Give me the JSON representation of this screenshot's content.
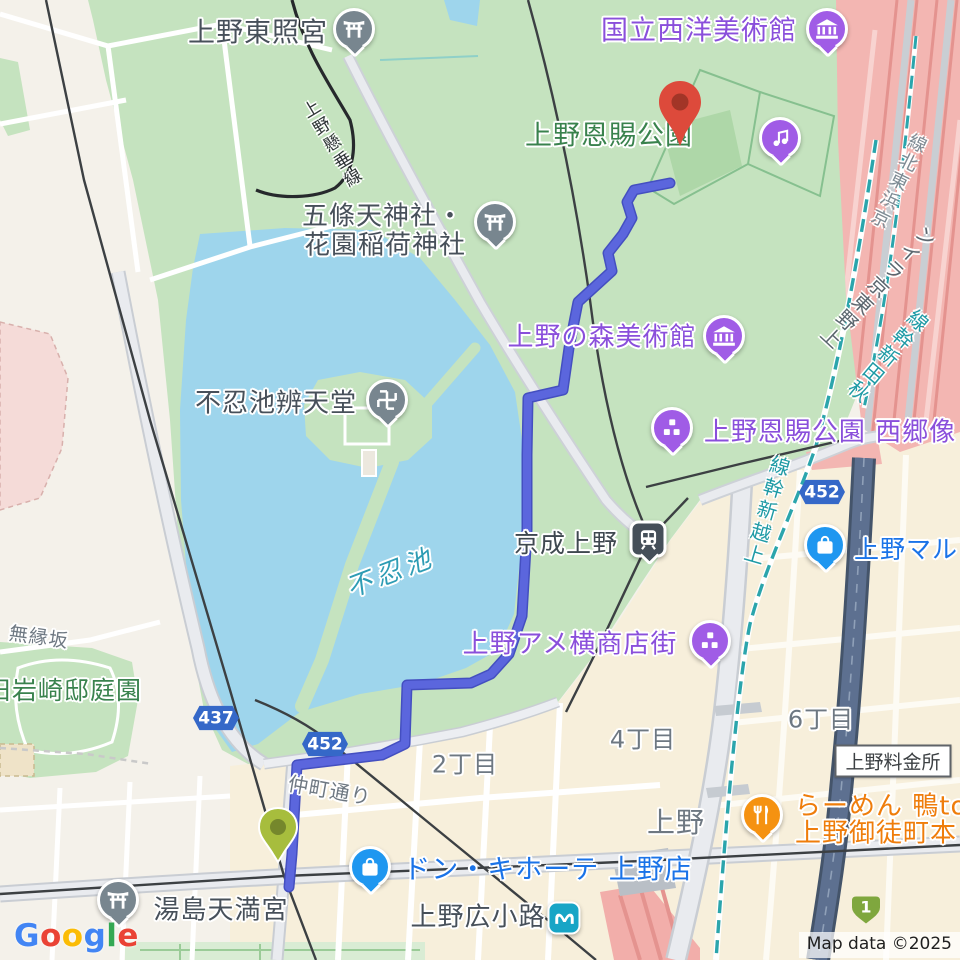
{
  "map": {
    "attribution": "Map data ©2025",
    "logo_letters": [
      "G",
      "o",
      "o",
      "g",
      "l",
      "e"
    ]
  },
  "colors": {
    "route_blue": "#5b66dd",
    "park_green": "#c5e3bf",
    "water_blue": "#9ed5ec",
    "rail_yard_pink": "#f3b6b2",
    "expressway_dark": "#5d7090",
    "city_blocks_cream": "#f7efdb",
    "road_shield_blue": "#3568c8",
    "expressway_shield_green": "#7fa73e",
    "poi_purple": "#a05ce6",
    "poi_gray": "#78868f",
    "poi_blue": "#1f97f0",
    "poi_orange": "#f59211",
    "destination_pin_red": "#dd4a3b",
    "start_pin_olive": "#a7bd3d"
  },
  "pois": {
    "ueno_toshogu": {
      "label": "上野東照宮"
    },
    "kokuritsu_seiyo_bijutsukan": {
      "label": "国立西洋美術館"
    },
    "ueno_onshi_koen": {
      "label": "上野恩賜公園"
    },
    "gojoten_jinja": {
      "label_line1": "五條天神社・",
      "label_line2": "花園稲荷神社"
    },
    "ueno_no_mori_bijutsukan": {
      "label": "上野の森美術館"
    },
    "shinobazunoike_bentendo": {
      "label": "不忍池辨天堂"
    },
    "saigo_statue": {
      "label": "上野恩賜公園 西郷像"
    },
    "keisei_ueno": {
      "label": "京成上野"
    },
    "ueno_maru": {
      "label": "上野マル"
    },
    "ameyoko": {
      "label": "上野アメ横商店街"
    },
    "kyu_iwasaki_tei": {
      "label": "旧岩崎邸庭園"
    },
    "yushima_tenmangu": {
      "label": "湯島天満宮"
    },
    "don_quijote": {
      "label": "ドン・キホーテ 上野店"
    },
    "ueno_hirokoji": {
      "label": "上野広小路"
    },
    "ramen_kamo": {
      "label_line1": "らーめん 鴨to",
      "label_line2": "上野御徒町本"
    },
    "ueno_tollgate": {
      "label": "上野料金所"
    }
  },
  "area_labels": {
    "shinobazu_pond": "不忍池",
    "muenzaka": "無縁坂",
    "nakacho_dori": "仲町通り",
    "chome2": "2丁目",
    "chome4": "4丁目",
    "chome6": "6丁目",
    "ueno": "上野"
  },
  "railway_labels": {
    "keihin_tohoku_line": "京浜東北線",
    "ueno_tokyo_line": "上野東京ライン",
    "akita_shinkansen": "秋田新幹線",
    "joetsu_shinkansen": "上越新幹線",
    "ueno_kensui_line": "上野懸垂線"
  },
  "shields": {
    "r437": "437",
    "r452a": "452",
    "r452b": "452",
    "expressway1": "1"
  }
}
